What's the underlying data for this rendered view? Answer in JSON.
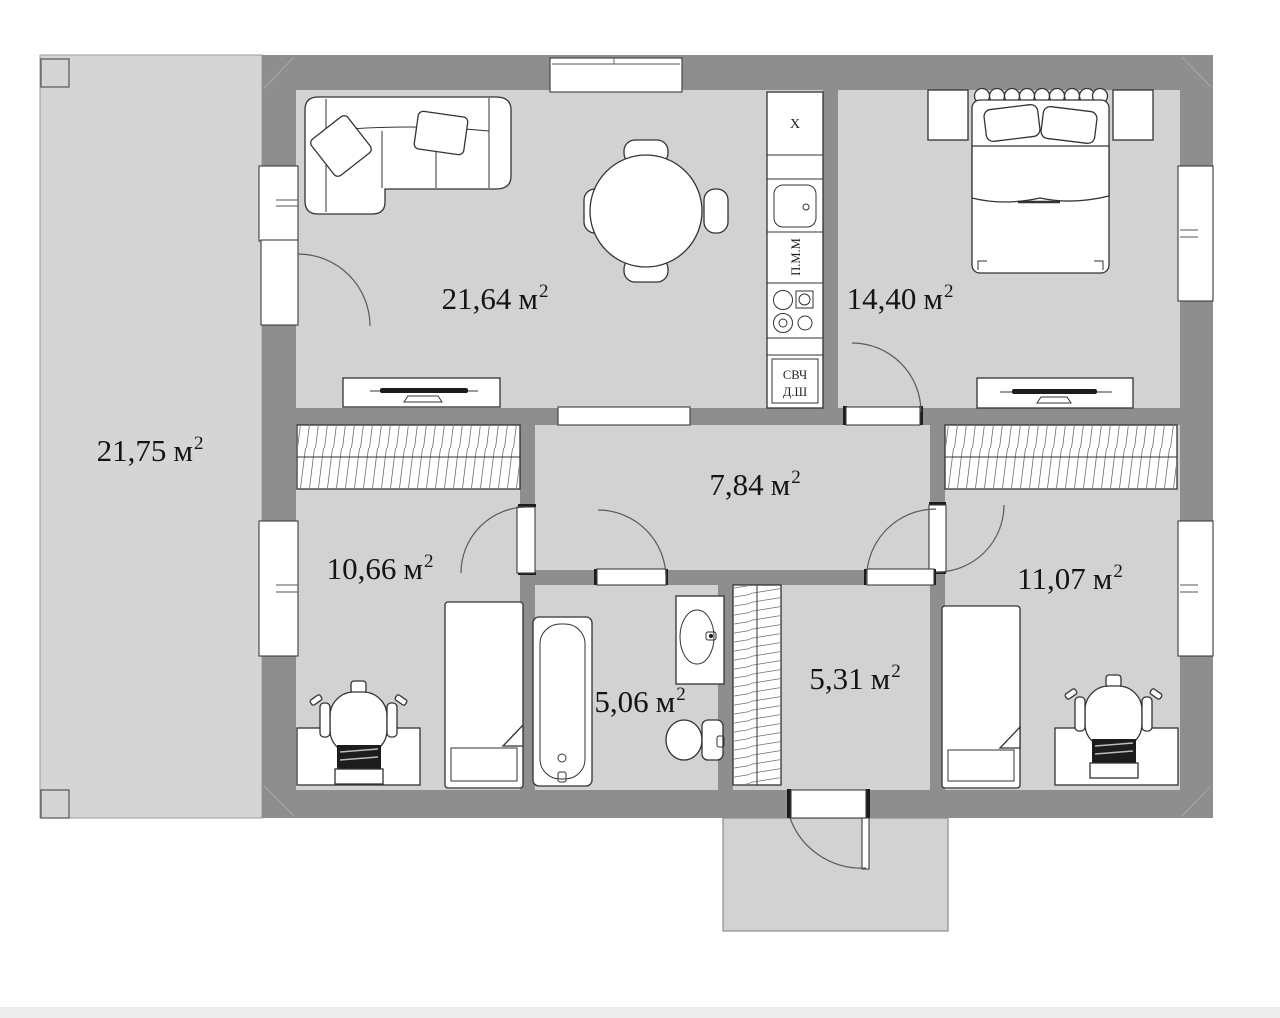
{
  "labels": {
    "unit": "м",
    "sup": "2"
  },
  "rooms": {
    "terrace": {
      "num": "21,75"
    },
    "living": {
      "num": "21,64"
    },
    "bedroom": {
      "num": "14,40"
    },
    "hall": {
      "num": "7,84"
    },
    "child1": {
      "num": "10,66"
    },
    "child2": {
      "num": "11,07"
    },
    "bath": {
      "num": "5,06"
    },
    "entry": {
      "num": "5,31"
    }
  },
  "kitchen": {
    "fridge": "X",
    "dishwasher": "П.М.М",
    "oven_line1": "СВЧ",
    "oven_line2": "Д.Ш"
  },
  "colors": {
    "wall": "#8e8e8e",
    "floor": "#d2d2d2",
    "terrace": "#d5d5d5",
    "line": "#3c3c3c"
  }
}
